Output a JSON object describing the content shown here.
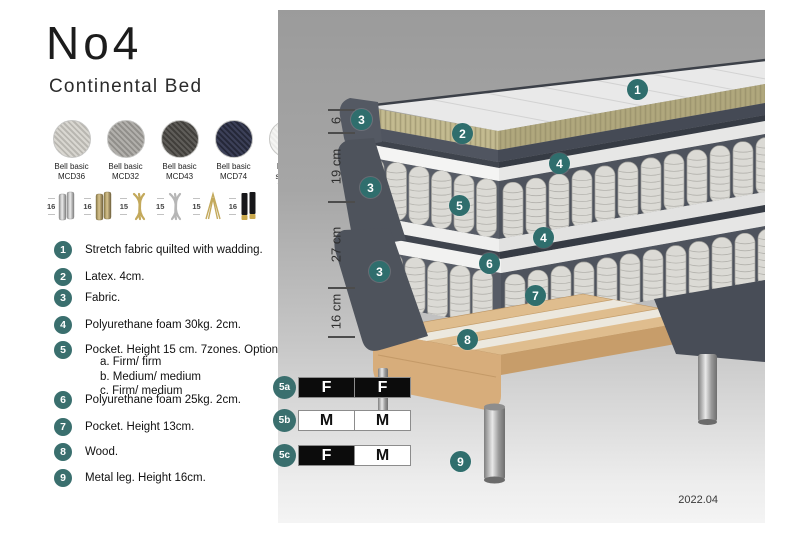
{
  "title": "No4",
  "subtitle": "Continental Bed",
  "fabrics": [
    {
      "name": "Bell basic",
      "code": "MCD36",
      "color": "#d9d7d1",
      "weave": "#b9b7b1"
    },
    {
      "name": "Bell basic",
      "code": "MCD32",
      "color": "#b2b0ac",
      "weave": "#918f8b"
    },
    {
      "name": "Bell basic",
      "code": "MCD43",
      "color": "#5f5d59",
      "weave": "#413f3b"
    },
    {
      "name": "Bell basic",
      "code": "MCD74",
      "color": "#3c4058",
      "weave": "#252839"
    },
    {
      "name": "Roma",
      "code": "stretch fabric",
      "color": "#f5f5f3",
      "weave": "#ebebe9"
    }
  ],
  "legs": [
    {
      "height": "16",
      "style": "chrome-cylinder-pair"
    },
    {
      "height": "16",
      "style": "brass-cylinder-pair"
    },
    {
      "height": "15",
      "style": "gold-twist"
    },
    {
      "height": "15",
      "style": "silver-twist"
    },
    {
      "height": "15",
      "style": "gold-hairpin"
    },
    {
      "height": "16",
      "style": "black-gold-cylinder-pair"
    }
  ],
  "list_items": [
    {
      "num": "1",
      "text": "Stretch fabric quilted with wadding."
    },
    {
      "num": "2",
      "text": "Latex. 4cm."
    },
    {
      "num": "3",
      "text": "Fabric."
    },
    {
      "num": "4",
      "text": "Polyurethane foam 30kg. 2cm."
    },
    {
      "num": "5",
      "text": "Pocket. Height 15 cm. 7zones. Option:",
      "sub": [
        "a. Firm/ firm",
        "b. Medium/ medium",
        "c. Firm/ medium"
      ]
    },
    {
      "num": "6",
      "text": "Polyurethane foam 25kg. 2cm."
    },
    {
      "num": "7",
      "text": "Pocket. Height 13cm."
    },
    {
      "num": "8",
      "text": "Wood."
    },
    {
      "num": "9",
      "text": "Metal leg. Height 16cm."
    }
  ],
  "diagram": {
    "dimensions": [
      "6",
      "19 cm",
      "27 cm",
      "16 cm"
    ],
    "badge_labels": [
      "1",
      "2",
      "3",
      "3",
      "3",
      "4",
      "4",
      "5",
      "6",
      "7",
      "8",
      "9"
    ],
    "firmness": [
      {
        "label": "5a",
        "cells": [
          {
            "text": "F",
            "variant": "dark"
          },
          {
            "text": "F",
            "variant": "dark"
          }
        ]
      },
      {
        "label": "5b",
        "cells": [
          {
            "text": "M",
            "variant": "light"
          },
          {
            "text": "M",
            "variant": "light"
          }
        ]
      },
      {
        "label": "5c",
        "cells": [
          {
            "text": "F",
            "variant": "dark"
          },
          {
            "text": "M",
            "variant": "light"
          }
        ]
      }
    ],
    "version": "2022.04"
  },
  "colors": {
    "accent_teal": "#3a6f6e",
    "badge_teal": "#2f6e6d",
    "latex_tan": "#c3ba90",
    "wood": "#dfbd8e",
    "dark_fabric": "#4e535c"
  }
}
